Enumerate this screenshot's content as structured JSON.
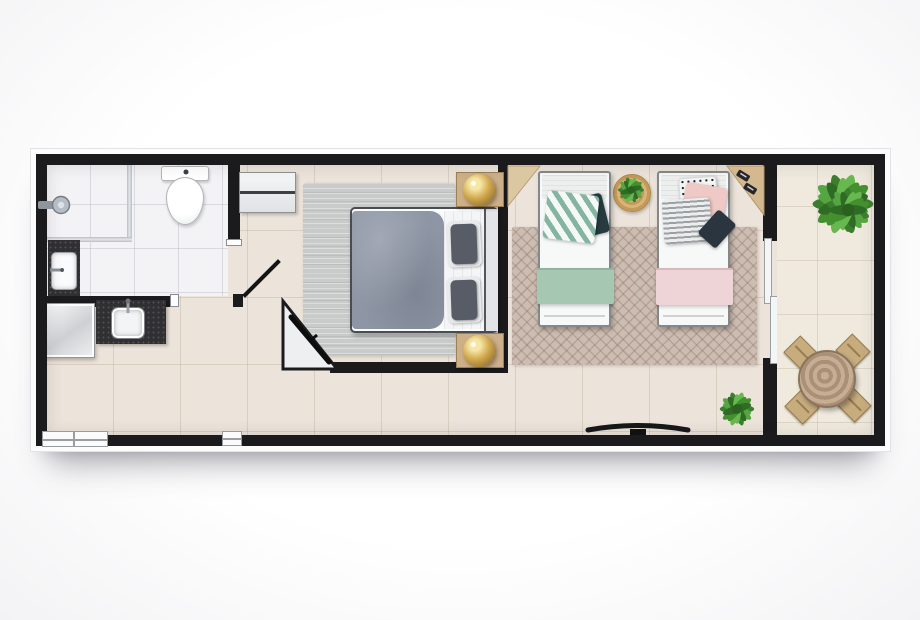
{
  "meta": {
    "title": "Studio apartment floor plan",
    "view": "top-down 3D architectural render",
    "text_visible": "none"
  },
  "palette": {
    "wall": "#1b1b1d",
    "trim": "#fcfcfd",
    "floor": "#ece4da",
    "bath_floor": "#f3f3f5",
    "balcony_floor": "#f0eade",
    "counter_dark": "#303033",
    "rug_gray": "#c9cbca",
    "rug_twin": "#ccbcb1",
    "duvet": "#8e96a5",
    "pillow_dark": "#575c66",
    "pillow_teal": "#84b4a2",
    "pillow_teal_dark": "#263b3f",
    "pillow_pink": "#efc9c5",
    "pillow_navy": "#2a3540",
    "blanket_green": "#a6c7b2",
    "blanket_pink": "#eed4d6",
    "wood_light": "#cdb089",
    "wood_desk": "#d4b88f",
    "gold": "#d2a94f",
    "plant_green": "#4a9138",
    "chair_wood": "#c7ac7e",
    "table_wood": "#b29879",
    "round_rug": "#cfa867"
  },
  "rooms": [
    {
      "name": "Bathroom",
      "items": [
        "walk-in shower with glass screen",
        "shower head",
        "toilet",
        "dark vanity counter with basin"
      ]
    },
    {
      "name": "Kitchenette",
      "items": [
        "metallic appliance",
        "dark counter with sink and faucet"
      ]
    },
    {
      "name": "Main bedroom",
      "items": [
        "double bed with gray duvet and two dark pillows",
        "light gray area rug",
        "white dresser",
        "two wooden side tables with brass lamps",
        "angled corner TV panel",
        "open door leaf"
      ]
    },
    {
      "name": "Twin bedroom",
      "items": [
        "single bed with teal chevron pillows and green blanket",
        "single bed with pink pillows and pink blanket",
        "geometric taupe rug",
        "round jute rug with potted plant",
        "corner wooden desk with accessories",
        "wall-mounted TV",
        "potted plant"
      ]
    },
    {
      "name": "Balcony",
      "items": [
        "sliding glass door",
        "large palm plant",
        "round wooden table",
        "four wooden chairs"
      ]
    }
  ]
}
